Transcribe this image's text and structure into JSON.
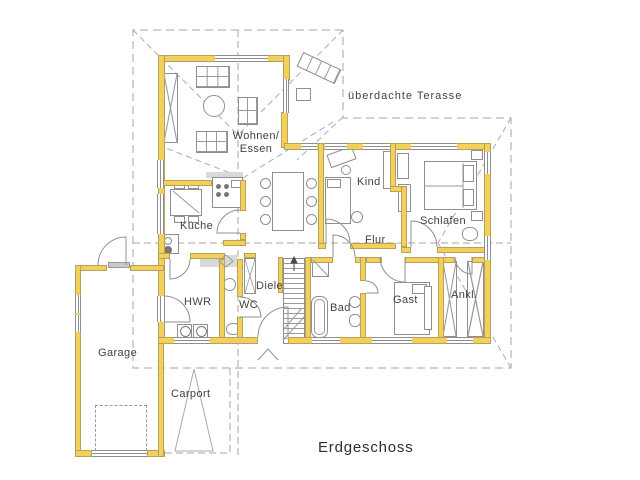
{
  "title": "Erdgeschoss",
  "labels": {
    "terrace": "überdachte Terasse",
    "wohnen_line1": "Wohnen/",
    "wohnen_line2": "Essen",
    "kueche": "Küche",
    "kind": "Kind",
    "schlafen": "Schlafen",
    "flur": "Flur",
    "hwr": "HWR",
    "diele": "Diele",
    "wc": "WC",
    "bad": "Bad",
    "gast": "Gast",
    "ankl": "Ankl.",
    "garage": "Garage",
    "carport": "Carport"
  },
  "colors": {
    "wall": "#f4d05a",
    "wall_edge": "#b3a35c",
    "furniture_line": "#8f8f8f",
    "dashed_line": "#a6a6a6",
    "text": "#424242"
  }
}
